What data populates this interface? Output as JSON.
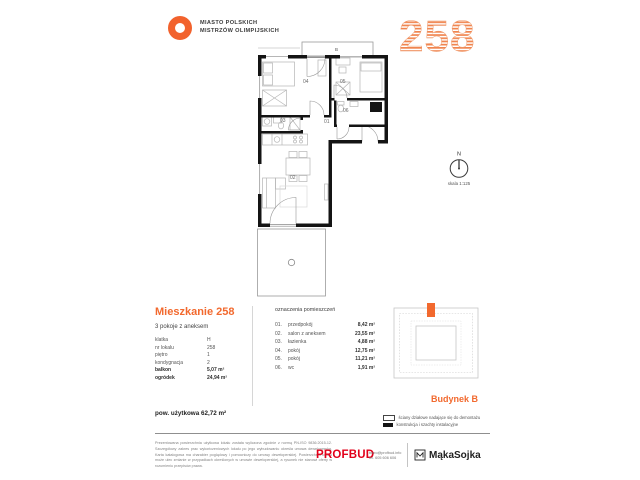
{
  "accent": "#f2692e",
  "header": {
    "brand_line1": "MIASTO POLSKICH",
    "brand_line2": "MISTRZÓW OLIMPIJSKICH",
    "unit_number": "258"
  },
  "plan": {
    "balcony_label": "B",
    "room_labels": {
      "r01": "01",
      "r02": "02",
      "r03": "03",
      "r04": "04",
      "r05": "05",
      "r06": "06"
    }
  },
  "compass": {
    "north": "N",
    "scale": "skala 1:125"
  },
  "apartment": {
    "title": "Mieszkanie 258",
    "subtitle": "3 pokoje z aneksem",
    "details": [
      {
        "label": "klatka",
        "value": "H"
      },
      {
        "label": "nr lokalu",
        "value": "258"
      },
      {
        "label": "piętro",
        "value": "1"
      },
      {
        "label": "kondygnacja",
        "value": "2"
      },
      {
        "label": "balkon",
        "value": "5,07 m²"
      },
      {
        "label": "ogródek",
        "value": "24,94 m²"
      }
    ],
    "usable_area_label": "pow. użytkowa",
    "usable_area_value": "62,72 m²"
  },
  "rooms": {
    "heading": "oznaczenia pomieszczeń",
    "items": [
      {
        "no": "01.",
        "name": "przedpokój",
        "area": "8,42 m²"
      },
      {
        "no": "02.",
        "name": "salon z aneksem",
        "area": "23,55 m²"
      },
      {
        "no": "03.",
        "name": "łazienka",
        "area": "4,88 m²"
      },
      {
        "no": "04.",
        "name": "pokój",
        "area": "12,75 m²"
      },
      {
        "no": "05.",
        "name": "pokój",
        "area": "11,21 m²"
      },
      {
        "no": "06.",
        "name": "wc",
        "area": "1,91 m²"
      }
    ]
  },
  "building": {
    "label": "Budynek B"
  },
  "legend": {
    "items": [
      {
        "label": "ściany działowe nadające się do demontażu"
      },
      {
        "label": "konstrukcja i szachty instalacyjne"
      }
    ]
  },
  "footer": {
    "disclaimer": "Prezentowana powierzchnia użytkowa lokalu została wyliczona zgodnie z normą PN-ISO 9836:2015-12. Szczegółowy zakres prac wykończeniowych lokalu po jego wybudowaniu określa umowa deweloperska. Karta katalogowa ma charakter poglądowy i pomocniczy do umowy deweloperskiej. Powierzchnia lokalu może ulec zmianie w przypadkach określonych w umowie deweloperskiej, a rysunek nie stanowi oferty w rozumieniu przepisów prawa.",
    "company": "PROFBUD",
    "contact_line1": "biuro@profbud.info",
    "contact_line2": "tel. 605 606 606",
    "architect": "MąkaSojka"
  }
}
